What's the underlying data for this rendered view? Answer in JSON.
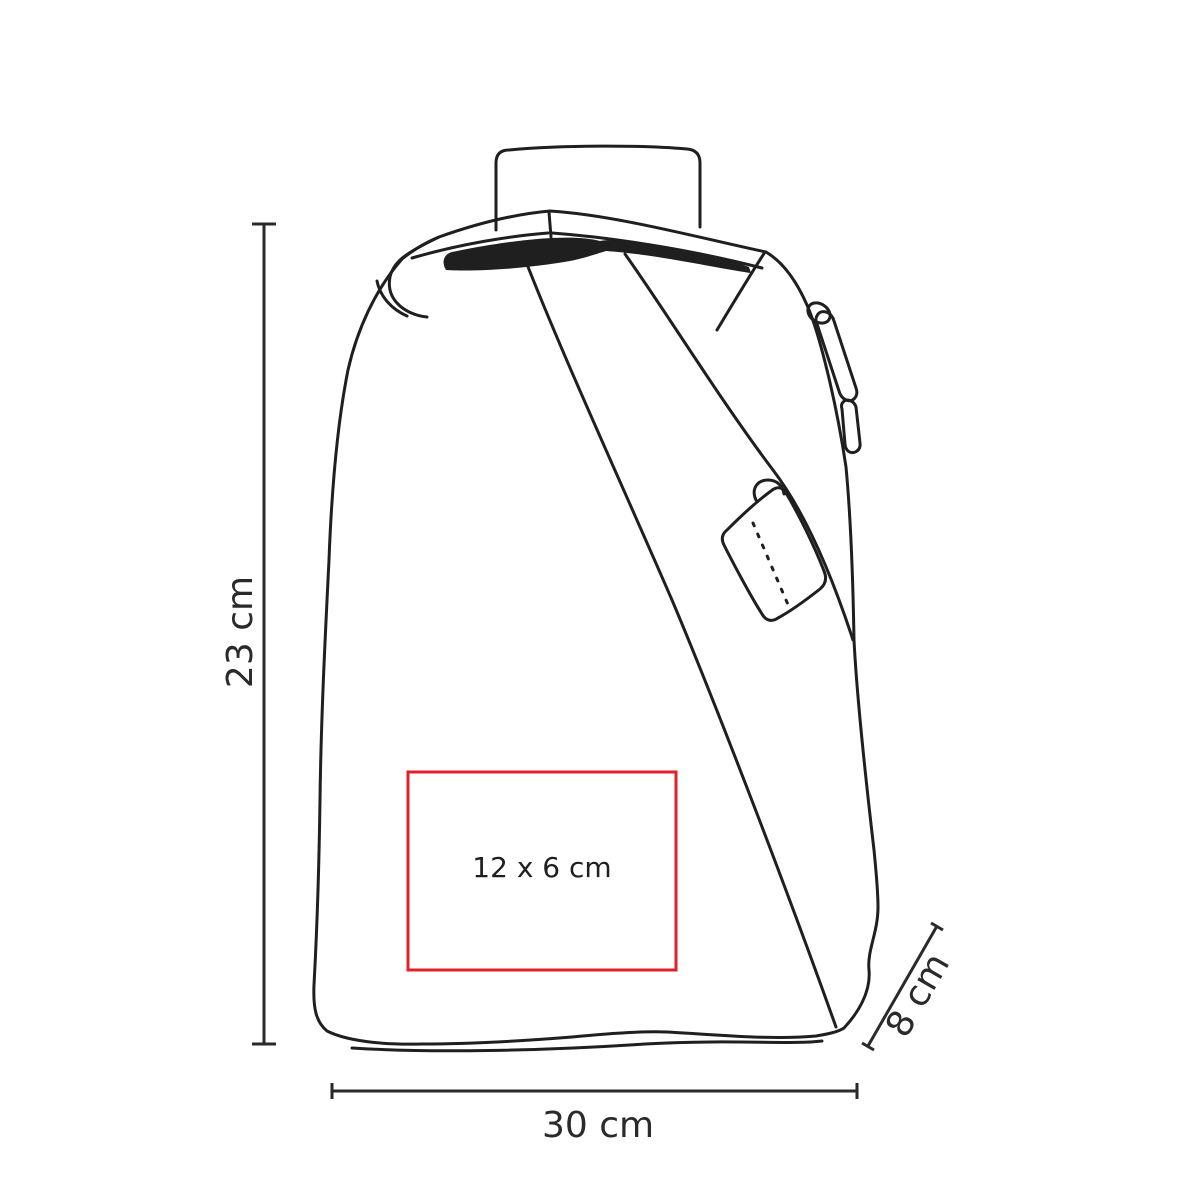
{
  "diagram": {
    "labels": {
      "height": "23 cm",
      "width": "30 cm",
      "depth": "8 cm",
      "print_area": "12 x 6 cm"
    },
    "colors": {
      "line": "#1f1f1f",
      "dimension": "#2a2a2a",
      "print_area_border": "#e02128",
      "background": "#ffffff"
    }
  }
}
